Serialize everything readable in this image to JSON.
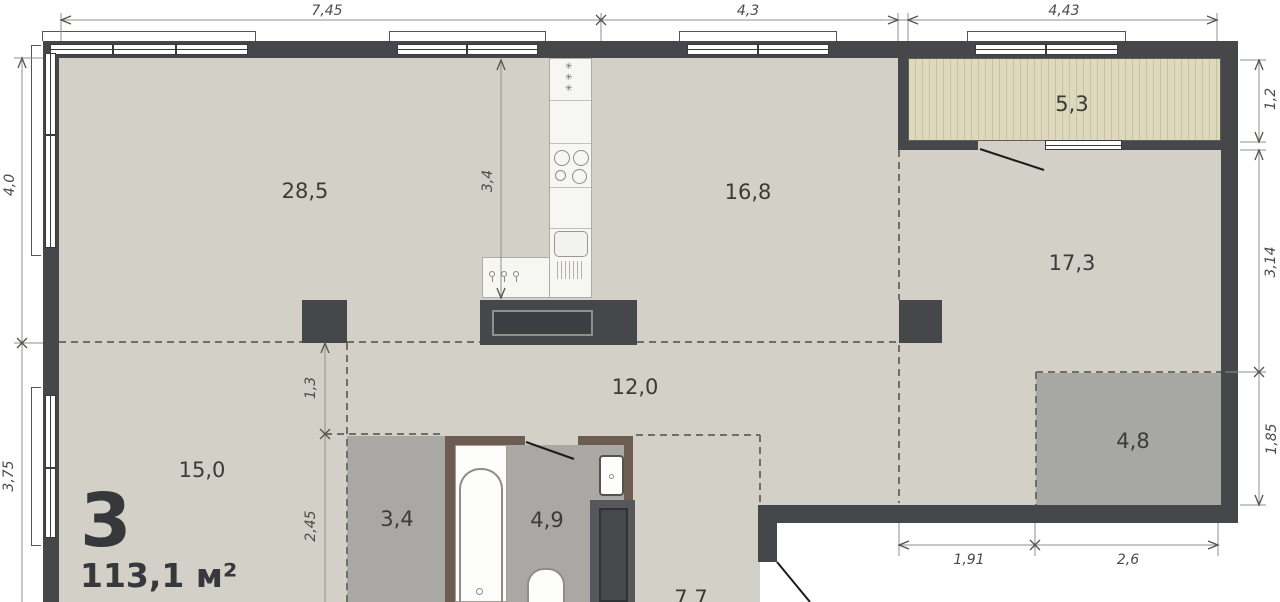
{
  "apartment": {
    "number": "3",
    "total_area": "113,1 м²"
  },
  "room_areas": {
    "living": "28,5",
    "kitchen": "16,8",
    "balcony": "5,3",
    "bedroom_right": "17,3",
    "hall": "12,0",
    "bedroom_left": "15,0",
    "wc": "3,4",
    "bathroom": "4,9",
    "corridor": "7,7",
    "wardrobe": "4,8"
  },
  "dimensions": {
    "top_left": "7,45",
    "top_mid": "4,3",
    "top_right": "4,43",
    "left_upper": "4,0",
    "left_lower": "3,75",
    "right_upper": "1,2",
    "right_mid": "3,14",
    "right_lower": "1,85",
    "bottom_left": "1,91",
    "bottom_right": "2,6",
    "kitchen_depth": "3,4",
    "hall_width": "1,3",
    "room_width": "2,45"
  },
  "glyphs": {
    "freezer_mark": "✳"
  },
  "colors": {
    "floor": "#d2d0c7",
    "wet_floor": "#a9a8a5",
    "balcony_floor": "#ded8bc",
    "wall": "#45474b",
    "wet_wall": "#6d5c52",
    "text": "#3b3b38",
    "dimension_text": "#4b4b48"
  }
}
